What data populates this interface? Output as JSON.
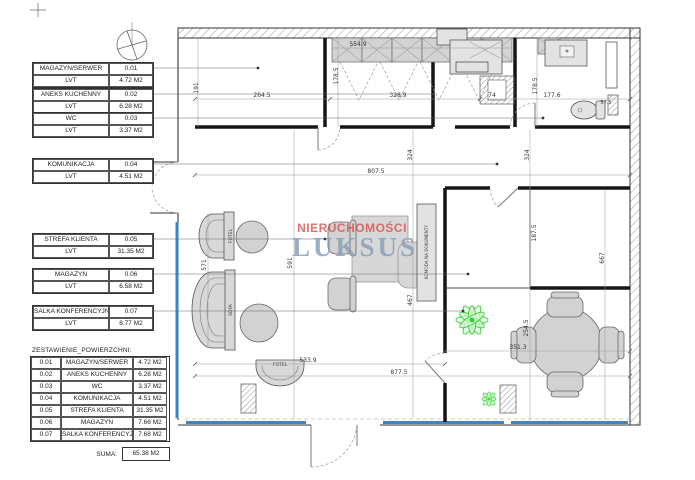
{
  "drawing": {
    "rooms": [
      {
        "name": "MAGAZYN/SERWER",
        "number": "0.01",
        "floor": "LVT",
        "area": "4.72 M2"
      },
      {
        "name": "ANEKS KUCHENNY",
        "number": "0.02",
        "floor": "LVT",
        "area": "6.28 M2"
      },
      {
        "name": "WC",
        "number": "0.03",
        "floor": "LVT",
        "area": "3.37 M2"
      },
      {
        "name": "KOMUNIKACJA",
        "number": "0.04",
        "floor": "LVT",
        "area": "4.51 M2"
      },
      {
        "name": "STREFA KLIENTA",
        "number": "0.05",
        "floor": "LVT",
        "area": "31.35 M2"
      },
      {
        "name": "MAGAZYN",
        "number": "0.06",
        "floor": "LVT",
        "area": "6.58 M2"
      },
      {
        "name": "SALKA KONFERENCYJNA",
        "number": "0.07",
        "floor": "LVT",
        "area": "8.77 M2"
      }
    ],
    "summary": {
      "title": "ZESTAWIENIE_POWIERZCHNI:",
      "rows": [
        [
          "0.01",
          "MAGAZYN/SERWER",
          "4.72 M2"
        ],
        [
          "0.02",
          "ANEKS KUCHENNY",
          "6.28 M2"
        ],
        [
          "0.03",
          "WC",
          "3.37 M2"
        ],
        [
          "0.04",
          "KOMUNIKACJA",
          "4.51 M2"
        ],
        [
          "0.05",
          "STREFA KLIENTA",
          "31.35 M2"
        ],
        [
          "0.06",
          "MAGAZYN",
          "7.66 M2"
        ],
        [
          "0.07",
          "SALKA KONFERENCYJNA",
          "7.68 M2"
        ]
      ],
      "sum_label": "SUMA:",
      "sum_value": "65.38 M2"
    },
    "watermark": {
      "line1": "NIERUCHOMOŚCI",
      "line2": "LUKSUS"
    },
    "furniture": {
      "sofa": "SOFA",
      "fotel_top": "FOTEL",
      "fotel_bottom": "FOTEL",
      "komoda": "KOMODA NA DOKUMENTY"
    },
    "dims": {
      "d554": "554.9",
      "d264": "264.5",
      "d191": "191",
      "d178a": "178.5",
      "d328": "328.9",
      "d74": "74",
      "d177": "177.6",
      "d178b": "178.5",
      "d57": "57.5",
      "d807": "807.5",
      "d324a": "324",
      "d324b": "324",
      "d187": "187.5",
      "d667": "667",
      "d467": "467",
      "d571": "571",
      "d591": "591",
      "d533": "533.9",
      "d877": "877.5",
      "d254": "254.5",
      "d351": "351.3"
    },
    "colors": {
      "window": "#3a86c8",
      "plant": "#2fcf2f",
      "watermark_red": "#d94f4c",
      "watermark_blue": "#8ba0b8"
    }
  }
}
